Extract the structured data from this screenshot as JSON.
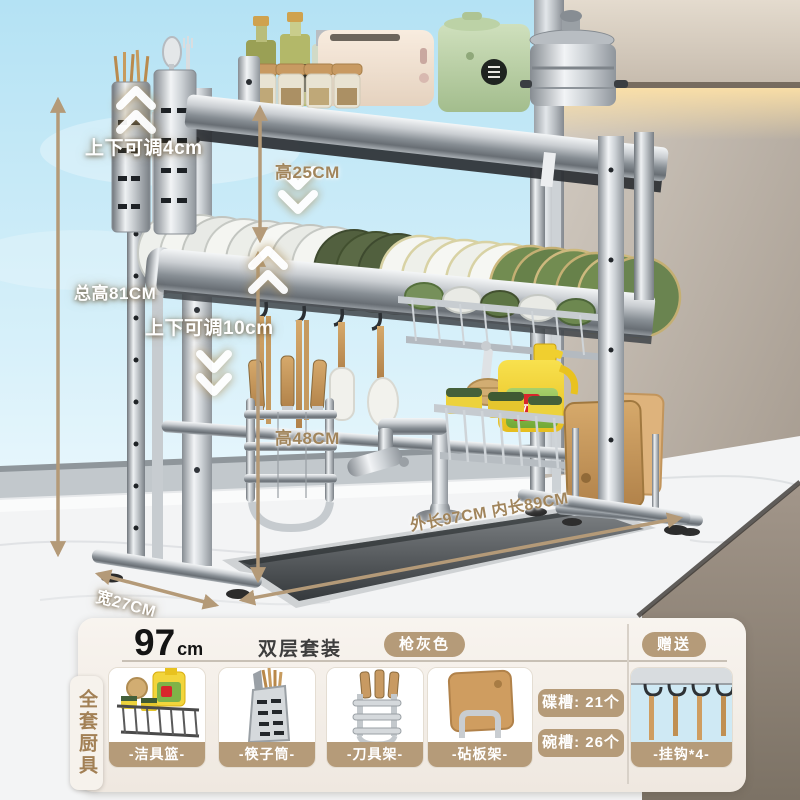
{
  "scene": {
    "annotations": {
      "adjust_top": "上下可调4cm",
      "tier_height": "高25CM",
      "total_height": "总高81CM",
      "adjust_bottom": "上下可调10cm",
      "clearance_height": "高48CM",
      "length": "外长97CM 内长89CM",
      "width": "宽27CM"
    },
    "detergent_brand": "立白",
    "colors": {
      "annotation_tan": "#a1855c",
      "arrow_tan": "#b49a78",
      "metal_gun_gray": "#9aa0a6",
      "sky": "#bde7f6"
    }
  },
  "panel": {
    "size_number": "97",
    "size_unit": "cm",
    "set_label": "双层套装",
    "color_badge": "枪灰色",
    "gift_badge": "赠送",
    "side_tab": "全套厨具",
    "badge_color": "#b59b79",
    "items": [
      {
        "label": "-洁具篮-"
      },
      {
        "label": "-筷子筒-"
      },
      {
        "label": "-刀具架-"
      },
      {
        "label": "-砧板架-"
      },
      {
        "label": "-挂钩*4-"
      }
    ],
    "slots": [
      {
        "label": "碟槽: 21个"
      },
      {
        "label": "碗槽: 26个"
      }
    ]
  }
}
